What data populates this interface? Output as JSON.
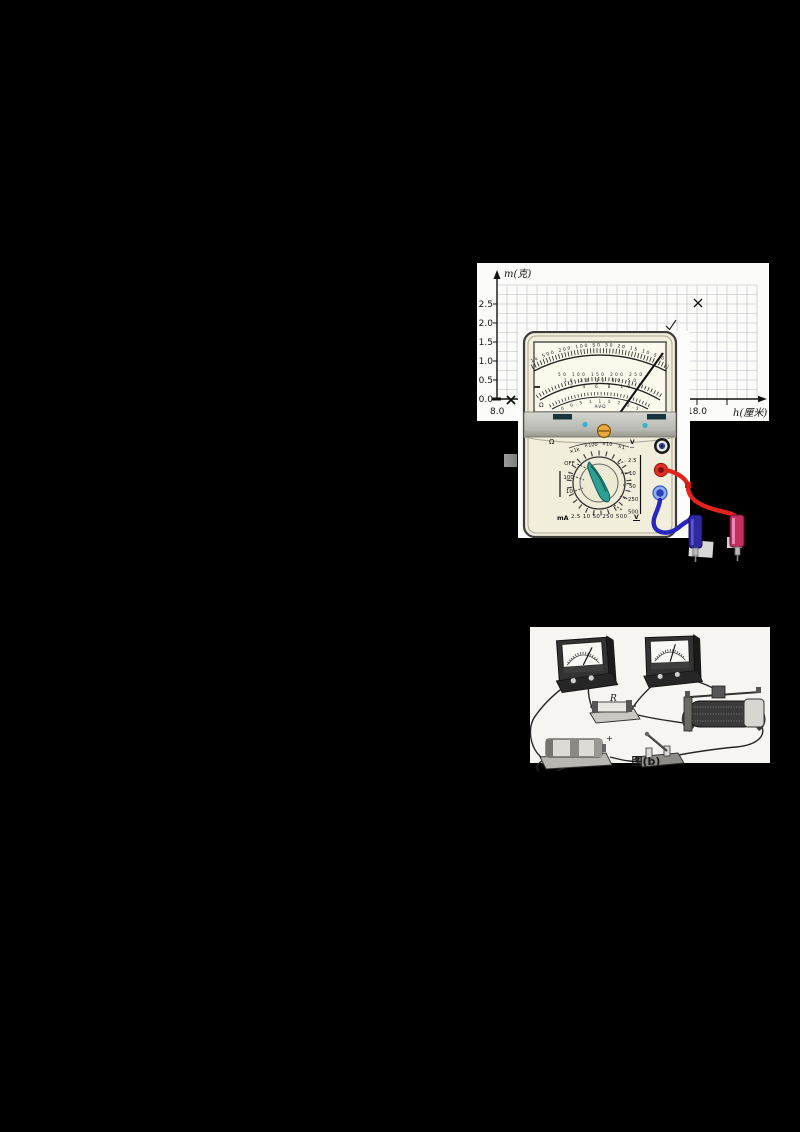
{
  "page": {
    "background": "#000000"
  },
  "graph": {
    "y_axis_label": "m(克)",
    "x_axis_label": "h(厘米)",
    "y_ticks": [
      "2.5",
      "2.0",
      "1.5",
      "1.0",
      "0.5",
      "0.0"
    ],
    "x_origin_label": "8.0",
    "x_tick_label": "18.0"
  },
  "chart_data": {
    "type": "scatter",
    "title": "",
    "xlabel": "h(厘米)",
    "ylabel": "m(克)",
    "x_range": [
      8.0,
      21.0
    ],
    "y_range": [
      0.0,
      3.0
    ],
    "grid": true,
    "x_tick_labels_visible": [
      "8.0",
      "18.0"
    ],
    "y_tick_labels_visible": [
      "0.0",
      "0.5",
      "1.0",
      "1.5",
      "2.0",
      "2.5"
    ],
    "points": [
      {
        "x": 8.7,
        "y": 0.0,
        "marker": "x"
      },
      {
        "x": 16.7,
        "y": 1.9,
        "marker": "check"
      },
      {
        "x": 18.0,
        "y": 2.5,
        "marker": "x"
      }
    ],
    "note_occlusion": "lower-middle of plot covered by multimeter image"
  },
  "multimeter": {
    "scale": {
      "ohm_row": "1k 500 200 100 50 30 20 15 10 5 0",
      "dc_rows": [
        "50 100 150 200 250",
        "10 20 30 40 50",
        "2 4 6 8 10"
      ],
      "low_ac_row": "0  0.5  1  1.5  2  2.5",
      "center_label": "A-V-Ω",
      "left_symbol": "Ω"
    },
    "dial": {
      "ohm_symbol": "Ω",
      "multipliers": [
        "×1k",
        "×100",
        "×10",
        "×1"
      ],
      "ac_v_label": "V",
      "ac_v_tilde": "~",
      "off_label": "OFF",
      "ma_ranges": [
        "100",
        "10"
      ],
      "ma_label": "mA",
      "right_v_ranges": [
        "2.5",
        "10",
        "50",
        "250",
        "500"
      ],
      "bottom_row": "2.5 10 50 250 500",
      "dc_v_label": "V"
    },
    "colors": {
      "body_cream": "#f2eedc",
      "knob_teal": "#2f9f93",
      "screw_orange": "#e9a93f",
      "wire_red": "#e4231c",
      "wire_blue": "#2726c1",
      "terminal_red": "#e23028",
      "terminal_blue": "#8fb0ea"
    }
  },
  "circuit": {
    "caption": "图(b)",
    "resistor_label": "R",
    "battery_plus": "+"
  }
}
